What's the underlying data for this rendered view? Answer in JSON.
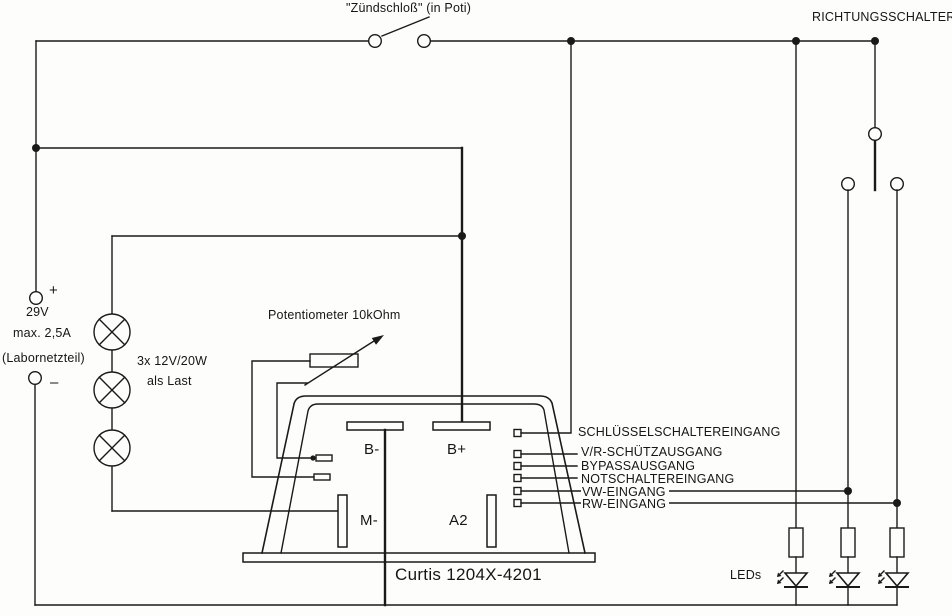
{
  "diagram": {
    "ignition_label": "\"Zündschloß\" (in Poti)",
    "direction_label": "RICHTUNGSSCHALTER",
    "supply": {
      "plus": "+",
      "minus": "–",
      "voltage": "29V",
      "current": "max. 2,5A",
      "name": "(Labornetzteil)"
    },
    "load": {
      "line1": "3x 12V/20W",
      "line2": "als Last"
    },
    "pot_label": "Potentiometer 10kOhm",
    "controller": {
      "name": "Curtis 1204X-4201",
      "b_minus": "B-",
      "b_plus": "B+",
      "m_minus": "M-",
      "a2": "A2"
    },
    "pins": [
      "SCHLÜSSELSCHALTEREINGANG",
      "V/R-SCHÜTZAUSGANG",
      "BYPASSAUSGANG",
      "NOTSCHALTEREINGANG",
      "VW-EINGANG",
      "RW-EINGANG"
    ],
    "leds_label": "LEDs"
  }
}
